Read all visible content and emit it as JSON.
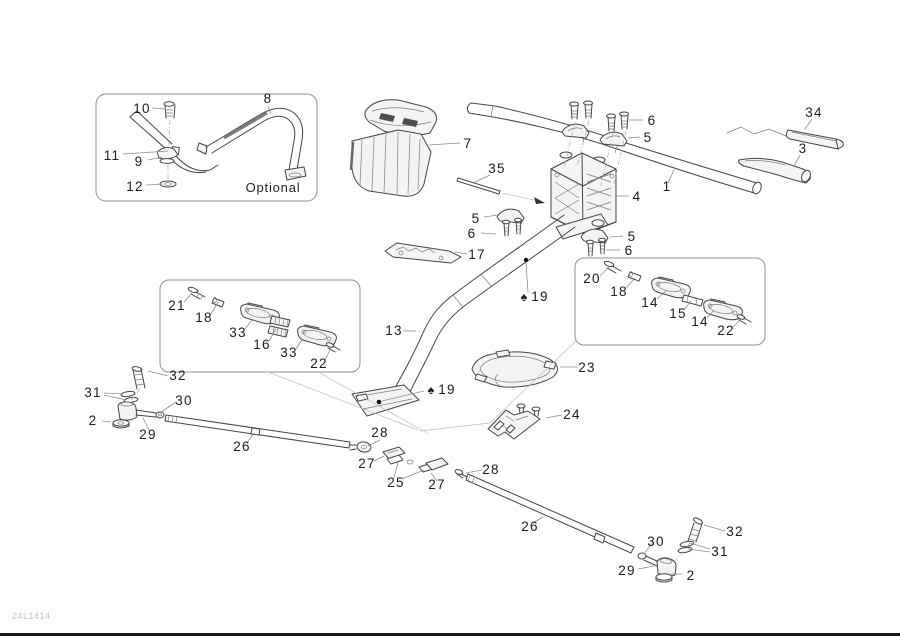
{
  "meta": {
    "drawing_code": "24L1414",
    "optional_label": "Optional"
  },
  "colors": {
    "line": "#454545",
    "leader": "#8c8c8c",
    "label": "#1c1c1c",
    "fill_light": "#f4f4f4",
    "code_text": "#c2c2c2"
  },
  "labels": [
    {
      "t": "10",
      "x": 142,
      "y": 113,
      "ln": [
        [
          152,
          108,
          166,
          109
        ]
      ]
    },
    {
      "t": "8",
      "x": 268,
      "y": 103,
      "ln": [
        [
          268,
          106,
          271,
          114
        ]
      ]
    },
    {
      "t": "11",
      "x": 112,
      "y": 160,
      "ln": [
        [
          123,
          154,
          168,
          151
        ]
      ]
    },
    {
      "t": "9",
      "x": 139,
      "y": 166,
      "ln": [
        [
          148,
          160,
          162,
          157
        ]
      ]
    },
    {
      "t": "12",
      "x": 135,
      "y": 191,
      "ln": [
        [
          146,
          185,
          162,
          184
        ]
      ]
    },
    {
      "t": "7",
      "x": 468,
      "y": 148,
      "ln": [
        [
          460,
          143,
          429,
          145
        ]
      ]
    },
    {
      "t": "35",
      "x": 497,
      "y": 173,
      "ln": [
        [
          490,
          175,
          473,
          183
        ]
      ]
    },
    {
      "t": "6",
      "x": 652,
      "y": 125,
      "ln": [
        [
          643,
          120,
          629,
          120
        ]
      ]
    },
    {
      "t": "5",
      "x": 648,
      "y": 142,
      "ln": [
        [
          640,
          137,
          628,
          138
        ]
      ]
    },
    {
      "t": "4",
      "x": 637,
      "y": 201,
      "ln": [
        [
          629,
          196,
          615,
          196
        ]
      ]
    },
    {
      "t": "1",
      "x": 667,
      "y": 191,
      "ln": [
        [
          668,
          183,
          674,
          170
        ]
      ]
    },
    {
      "t": "34",
      "x": 814,
      "y": 117,
      "ln": [
        [
          812,
          119,
          805,
          129
        ]
      ]
    },
    {
      "t": "3",
      "x": 803,
      "y": 153,
      "ln": [
        [
          800,
          155,
          794,
          166
        ]
      ]
    },
    {
      "t": "5",
      "x": 476,
      "y": 223,
      "ln": [
        [
          484,
          217,
          498,
          215
        ]
      ]
    },
    {
      "t": "6",
      "x": 472,
      "y": 238,
      "ln": [
        [
          481,
          233,
          496,
          234
        ]
      ]
    },
    {
      "t": "17",
      "x": 477,
      "y": 259,
      "ln": [
        [
          467,
          254,
          455,
          252
        ]
      ]
    },
    {
      "t": "5",
      "x": 632,
      "y": 241,
      "ln": [
        [
          623,
          236,
          610,
          237
        ]
      ]
    },
    {
      "t": "6",
      "x": 629,
      "y": 255,
      "ln": [
        [
          620,
          250,
          606,
          250
        ]
      ]
    },
    {
      "t": "20",
      "x": 592,
      "y": 283,
      "ln": [
        [
          600,
          276,
          609,
          267
        ]
      ]
    },
    {
      "t": "18",
      "x": 619,
      "y": 296,
      "ln": [
        [
          626,
          288,
          635,
          278
        ]
      ]
    },
    {
      "t": "14",
      "x": 650,
      "y": 307,
      "ln": [
        [
          657,
          299,
          667,
          290
        ]
      ]
    },
    {
      "t": "15",
      "x": 678,
      "y": 318,
      "ln": [
        [
          684,
          310,
          691,
          301
        ]
      ]
    },
    {
      "t": "14",
      "x": 700,
      "y": 326,
      "ln": [
        [
          707,
          318,
          714,
          310
        ]
      ]
    },
    {
      "t": "22",
      "x": 726,
      "y": 335,
      "ln": [
        [
          733,
          327,
          741,
          319
        ]
      ]
    },
    {
      "t": "21",
      "x": 177,
      "y": 310,
      "ln": [
        [
          184,
          302,
          192,
          293
        ]
      ]
    },
    {
      "t": "18",
      "x": 204,
      "y": 322,
      "ln": [
        [
          211,
          314,
          218,
          302
        ]
      ]
    },
    {
      "t": "33",
      "x": 238,
      "y": 337,
      "ln": [
        [
          245,
          329,
          252,
          320
        ]
      ]
    },
    {
      "t": "16",
      "x": 262,
      "y": 349,
      "ln": [
        [
          269,
          341,
          276,
          329
        ]
      ]
    },
    {
      "t": "33",
      "x": 289,
      "y": 357,
      "ln": [
        [
          296,
          349,
          302,
          340
        ]
      ]
    },
    {
      "t": "22",
      "x": 319,
      "y": 368,
      "ln": [
        [
          325,
          360,
          331,
          348
        ]
      ]
    },
    {
      "t": "32",
      "x": 178,
      "y": 380,
      "ln": [
        [
          168,
          376,
          148,
          371
        ]
      ]
    },
    {
      "t": "31",
      "x": 93,
      "y": 397,
      "ln": [
        [
          104,
          393,
          123,
          394
        ],
        [
          104,
          395,
          126,
          400
        ]
      ]
    },
    {
      "t": "30",
      "x": 184,
      "y": 405,
      "ln": [
        [
          176,
          402,
          161,
          412
        ]
      ]
    },
    {
      "t": "2",
      "x": 93,
      "y": 425,
      "ln": [
        [
          102,
          421,
          111,
          422
        ]
      ]
    },
    {
      "t": "29",
      "x": 148,
      "y": 439,
      "ln": [
        [
          149,
          430,
          143,
          418
        ]
      ]
    },
    {
      "t": "26",
      "x": 242,
      "y": 451,
      "ln": [
        [
          247,
          443,
          254,
          433
        ]
      ]
    },
    {
      "t": "♠",
      "x": 524,
      "y": 301,
      "cls": "sym"
    },
    {
      "t": "19",
      "x": 540,
      "y": 301,
      "ln": [
        [
          526,
          263,
          528,
          292
        ]
      ]
    },
    {
      "t": "13",
      "x": 394,
      "y": 335,
      "ln": [
        [
          403,
          331,
          416,
          331
        ]
      ]
    },
    {
      "t": "♠",
      "x": 431,
      "y": 394,
      "cls": "sym"
    },
    {
      "t": "19",
      "x": 447,
      "y": 394,
      "ln": [
        [
          382,
          401,
          424,
          391
        ]
      ]
    },
    {
      "t": "23",
      "x": 587,
      "y": 372,
      "ln": [
        [
          578,
          367,
          560,
          367
        ]
      ]
    },
    {
      "t": "24",
      "x": 572,
      "y": 419,
      "ln": [
        [
          562,
          415,
          546,
          418
        ]
      ]
    },
    {
      "t": "28",
      "x": 380,
      "y": 437,
      "ln": [
        [
          380,
          440,
          368,
          446
        ]
      ]
    },
    {
      "t": "27",
      "x": 367,
      "y": 468,
      "ln": [
        [
          374,
          461,
          384,
          456
        ]
      ]
    },
    {
      "t": "25",
      "x": 396,
      "y": 487,
      "ln": [
        [
          394,
          478,
          398,
          462
        ],
        [
          402,
          479,
          424,
          470
        ]
      ]
    },
    {
      "t": "27",
      "x": 437,
      "y": 489,
      "ln": [
        [
          437,
          481,
          431,
          473
        ]
      ]
    },
    {
      "t": "28",
      "x": 491,
      "y": 474,
      "ln": [
        [
          482,
          470,
          466,
          473
        ]
      ]
    },
    {
      "t": "26",
      "x": 530,
      "y": 531,
      "ln": [
        [
          533,
          523,
          543,
          517
        ]
      ]
    },
    {
      "t": "30",
      "x": 656,
      "y": 546,
      "ln": [
        [
          653,
          542,
          644,
          554
        ]
      ]
    },
    {
      "t": "32",
      "x": 735,
      "y": 536,
      "ln": [
        [
          725,
          531,
          704,
          525
        ]
      ]
    },
    {
      "t": "31",
      "x": 720,
      "y": 556,
      "ln": [
        [
          710,
          549,
          690,
          543
        ],
        [
          710,
          552,
          688,
          549
        ]
      ]
    },
    {
      "t": "29",
      "x": 627,
      "y": 575,
      "ln": [
        [
          638,
          569,
          654,
          566
        ]
      ]
    },
    {
      "t": "2",
      "x": 691,
      "y": 580,
      "ln": [
        [
          682,
          574,
          671,
          574
        ]
      ]
    }
  ]
}
